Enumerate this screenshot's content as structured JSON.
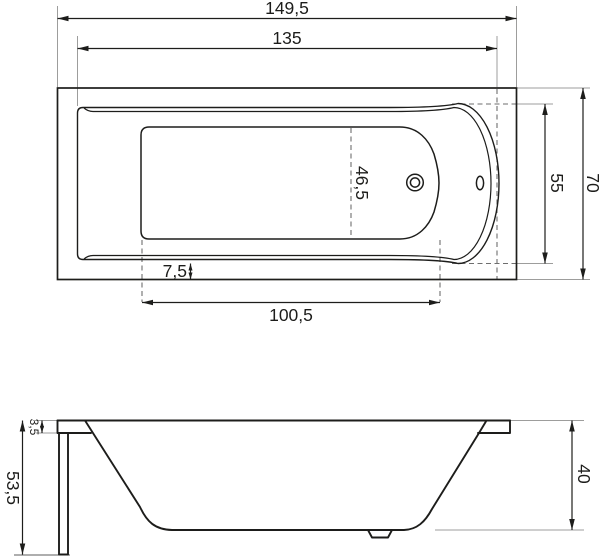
{
  "drawing": {
    "type": "bathtub-technical-drawing",
    "colors": {
      "line": "#1d1d1b",
      "extension_line": "#9d9d9c",
      "dashed_line": "#6e6e6e",
      "background": "#ffffff"
    },
    "views": {
      "top": {
        "dims": {
          "overall_length": "149,5",
          "rim_inner_length": "135",
          "overall_width": "70",
          "rim_inner_width": "55",
          "floor_width_center": "46,5",
          "rim_edge_offset": "7,5",
          "floor_length": "100,5"
        }
      },
      "side": {
        "dims": {
          "total_height": "53,5",
          "rim_lip_height": "3,5",
          "inner_depth": "40"
        }
      }
    }
  }
}
